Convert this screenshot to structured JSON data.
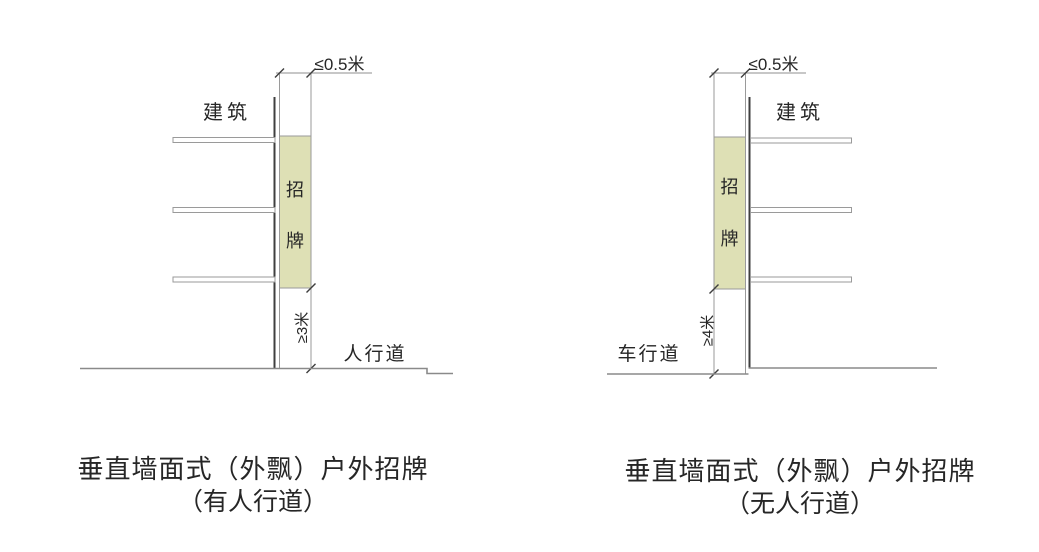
{
  "colors": {
    "sign_fill": "#dee0b5",
    "wall_line": "#3f3f3f",
    "outline": "#9a9a9a",
    "ground_line": "#8a8a8a",
    "text": "#262626"
  },
  "diagrams": [
    {
      "side": "left",
      "top_dimension_label": "≤0.5米",
      "building_label": "建筑",
      "sign_char_1": "招",
      "sign_char_2": "牌",
      "clearance_label": "≥3米",
      "ground_label": "人行道",
      "caption_line_1": "垂直墙面式（外飘）户外招牌",
      "caption_line_2": "（有人行道）"
    },
    {
      "side": "right",
      "top_dimension_label": "≤0.5米",
      "building_label": "建筑",
      "sign_char_1": "招",
      "sign_char_2": "牌",
      "clearance_label": "≥4米",
      "ground_label": "车行道",
      "caption_line_1": "垂直墙面式（外飘）户外招牌",
      "caption_line_2": "（无人行道）"
    }
  ]
}
